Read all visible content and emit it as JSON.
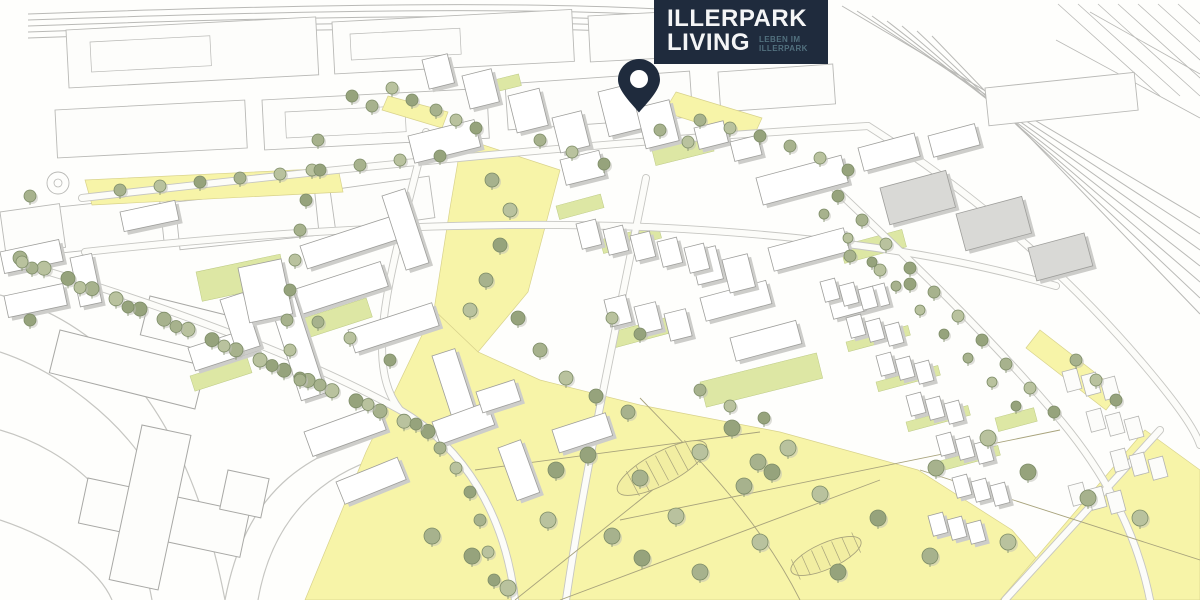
{
  "logo": {
    "title_line1": "ILLERPARK",
    "title_line2": "LIVING",
    "tagline_line1": "LEBEN IM",
    "tagline_line2": "ILLERPARK"
  },
  "icons": {
    "location_pin": "location-pin-icon"
  },
  "colors": {
    "navy": "#1f2b3d",
    "tagline": "#52707e",
    "park_yellow": "#f7f4a8",
    "park_edge": "#d8d28c",
    "lawn_green": "#dde7a4",
    "tree_fill": "#a7b28d",
    "tree_fill_light": "#b9c29e",
    "tree_fill_dark": "#96a37c",
    "tree_stroke": "#7d8c67",
    "building_face": "#ffffff",
    "building_shade": "#d9d9d6",
    "building_shadow": "#cdcdca",
    "building_outline": "#9e9e9b",
    "linework": "#b9b9b6",
    "road_edge": "#c6c6c2",
    "road_fill": "#fcfcf9",
    "path_line": "#a8a37c",
    "pin_hole": "#ffffff"
  }
}
